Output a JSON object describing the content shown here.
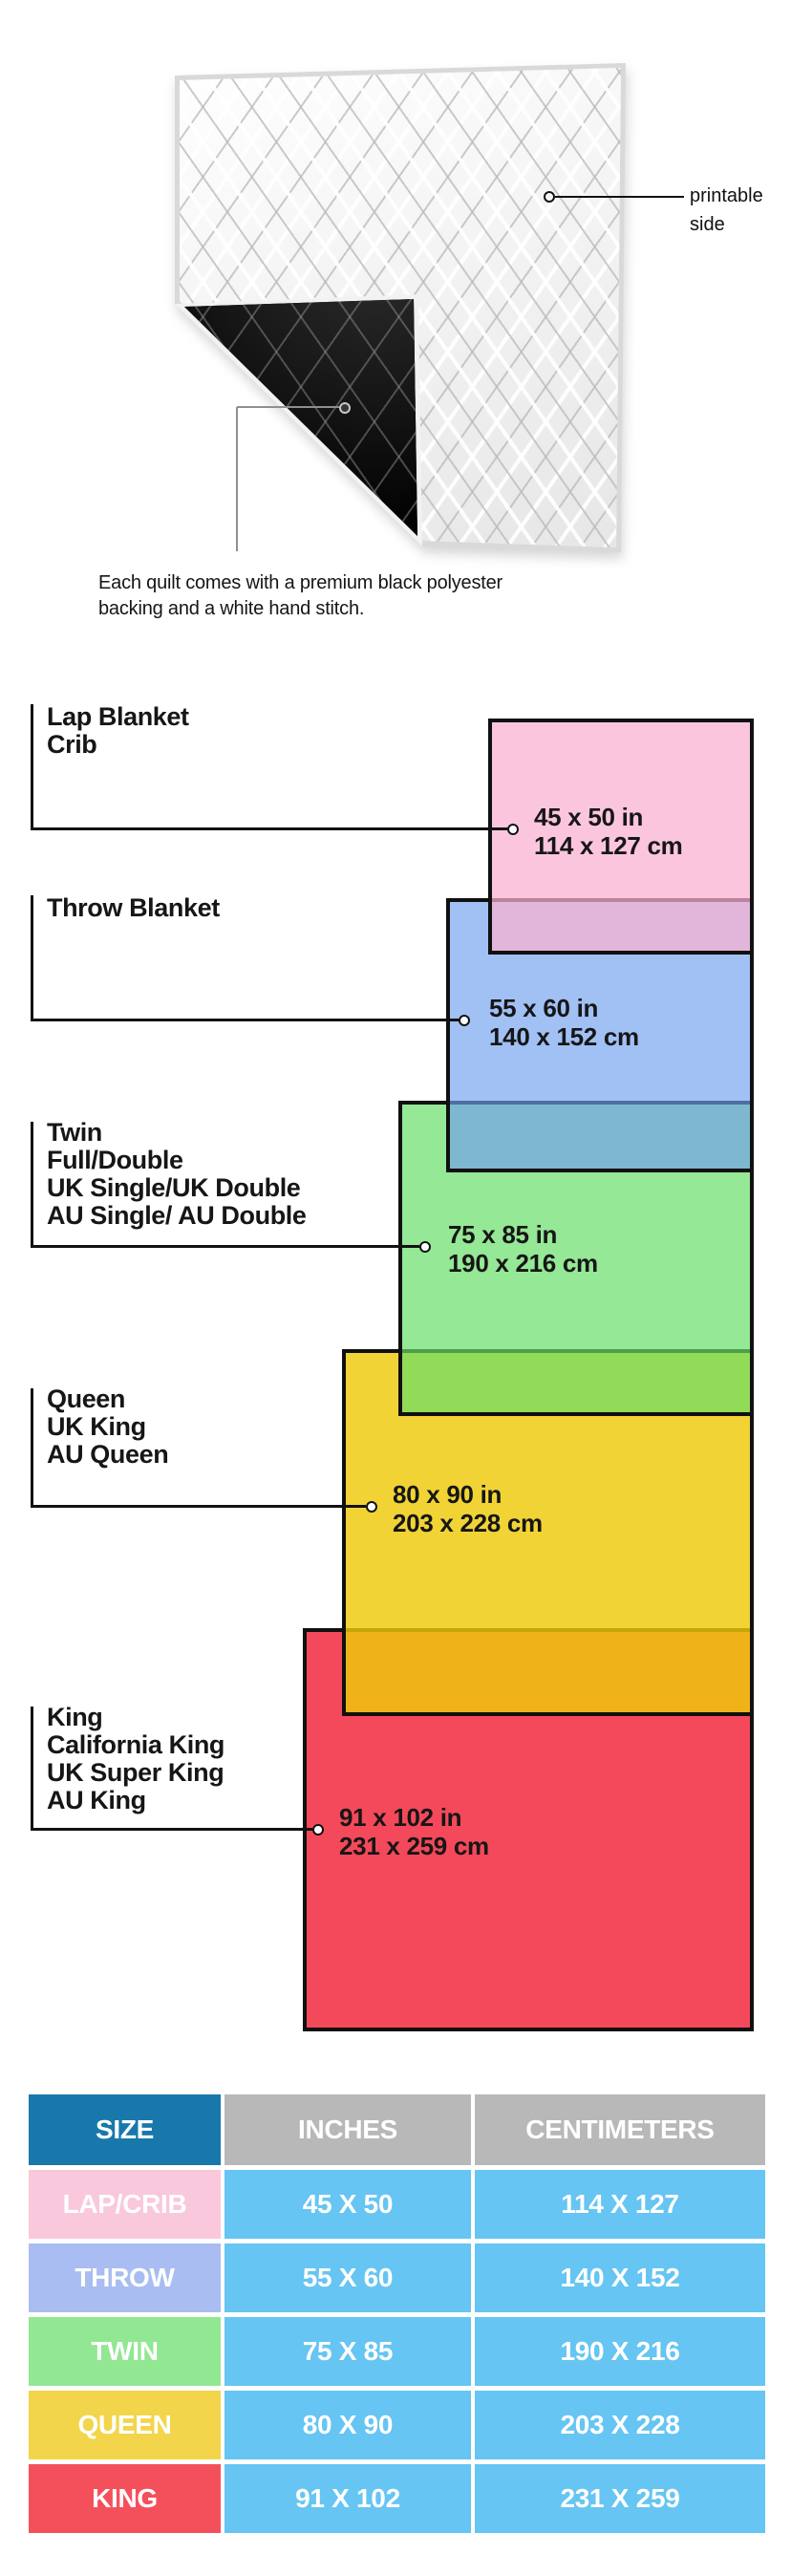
{
  "quilt": {
    "printable_label_line1": "printable",
    "printable_label_line2": "side",
    "description_line1": "Each quilt comes with a premium black polyester",
    "description_line2": "backing and a white hand stitch."
  },
  "diagram": {
    "sizes": [
      {
        "id": "lap",
        "labels": [
          "Lap Blanket",
          "Crib"
        ],
        "inches": "45 x 50 in",
        "cm": "114 x 127 cm",
        "color": "#fbc7dd",
        "fill": "rgba(250,177,208,0.73)"
      },
      {
        "id": "throw",
        "labels": [
          "Throw Blanket"
        ],
        "inches": "55 x 60 in",
        "cm": "140 x 152 cm",
        "color": "#a4c2f4",
        "fill": "rgba(113,160,238,0.66)"
      },
      {
        "id": "twin",
        "labels": [
          "Twin",
          "Full/Double",
          "UK Single/UK Double",
          "AU Single/ AU Double"
        ],
        "inches": "75 x 85 in",
        "cm": "190 x 216 cm",
        "color": "#97e897",
        "fill": "rgba(104,222,104,0.70)"
      },
      {
        "id": "queen",
        "labels": [
          "Queen",
          "UK King",
          "AU Queen"
        ],
        "inches": "80 x 90 in",
        "cm": "203 x 228 cm",
        "color": "#f2d83f",
        "fill": "rgba(238,201,10,0.82)"
      },
      {
        "id": "king",
        "labels": [
          "King",
          "California King",
          "UK Super King",
          "AU King"
        ],
        "inches": "91 x 102 in",
        "cm": "231 x 259 cm",
        "color": "#f4495a",
        "fill": "#f4495a"
      }
    ]
  },
  "table": {
    "headers": [
      "SIZE",
      "INCHES",
      "CENTIMETERS"
    ],
    "header_colors": {
      "size_bg": "#1878ac",
      "other_bg": "#b8b8b8"
    },
    "value_bg": "#66c5f2",
    "rows": [
      {
        "size": "LAP/CRIB",
        "inches": "45 X 50",
        "cm": "114 X 127",
        "color": "#f9c8dc"
      },
      {
        "size": "THROW",
        "inches": "55 X 60",
        "cm": "140 X 152",
        "color": "#a9bdf2"
      },
      {
        "size": "TWIN",
        "inches": "75 X 85",
        "cm": "190 X 216",
        "color": "#92e792"
      },
      {
        "size": "QUEEN",
        "inches": "80 X 90",
        "cm": "203 X 228",
        "color": "#f2d54b"
      },
      {
        "size": "KING",
        "inches": "91 X 102",
        "cm": "231 X 259",
        "color": "#f4505c"
      }
    ]
  }
}
